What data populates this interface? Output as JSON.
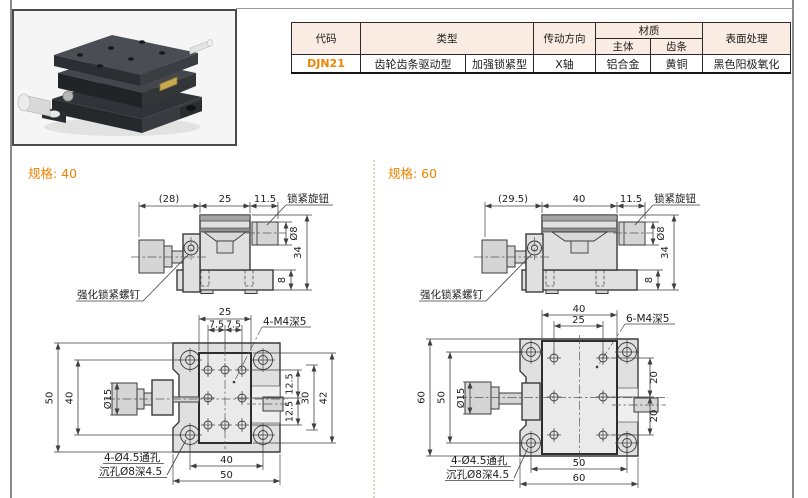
{
  "accent_color": "#f08300",
  "spec_table": {
    "headers": {
      "code": "代码",
      "type": "类型",
      "direction": "传动方向",
      "material": "材质",
      "material_body": "主体",
      "material_rack": "齿条",
      "surface": "表面处理"
    },
    "row": {
      "code": "DJN21",
      "type_a": "齿轮齿条驱动型",
      "type_b": "加强锁紧型",
      "direction": "X轴",
      "material_body": "铝合金",
      "material_rack": "黄铜",
      "surface": "黑色阳极氧化"
    }
  },
  "sections": [
    {
      "label": "规格: 40",
      "side": {
        "overall": "(28)",
        "body": "25",
        "knob": "11.5",
        "knob_dia": "Ø8",
        "height": "34",
        "base_h": "8",
        "lock_knob": "锁紧旋钮",
        "lock_screw": "强化锁紧螺钉"
      },
      "plan": {
        "table_w": "25",
        "pitch_l": "7.5",
        "pitch_r": "7.5",
        "tap": "4-M4深5",
        "outer": "50",
        "hole_pitch": "40",
        "knob_dia": "Ø15",
        "right_a": "12.5",
        "right_b": "12.5",
        "right_c": "30",
        "right_d": "42",
        "bottom_a": "40",
        "bottom_b": "50",
        "note1": "4-Ø4.5通孔",
        "note2": "沉孔Ø8深4.5"
      }
    },
    {
      "label": "规格: 60",
      "side": {
        "overall": "(29.5)",
        "body": "40",
        "knob": "11.5",
        "knob_dia": "Ø8",
        "height": "34",
        "base_h": "8",
        "lock_knob": "锁紧旋钮",
        "lock_screw": "强化锁紧螺钉"
      },
      "plan": {
        "table_w": "40",
        "pitch": "25",
        "tap": "6-M4深5",
        "outer": "60",
        "hole_pitch": "50",
        "knob_dia": "Ø15",
        "right_a": "20",
        "right_b": "20",
        "bottom_a": "50",
        "bottom_b": "60",
        "note1": "4-Ø4.5通孔",
        "note2": "沉孔Ø8深4.5"
      }
    }
  ]
}
